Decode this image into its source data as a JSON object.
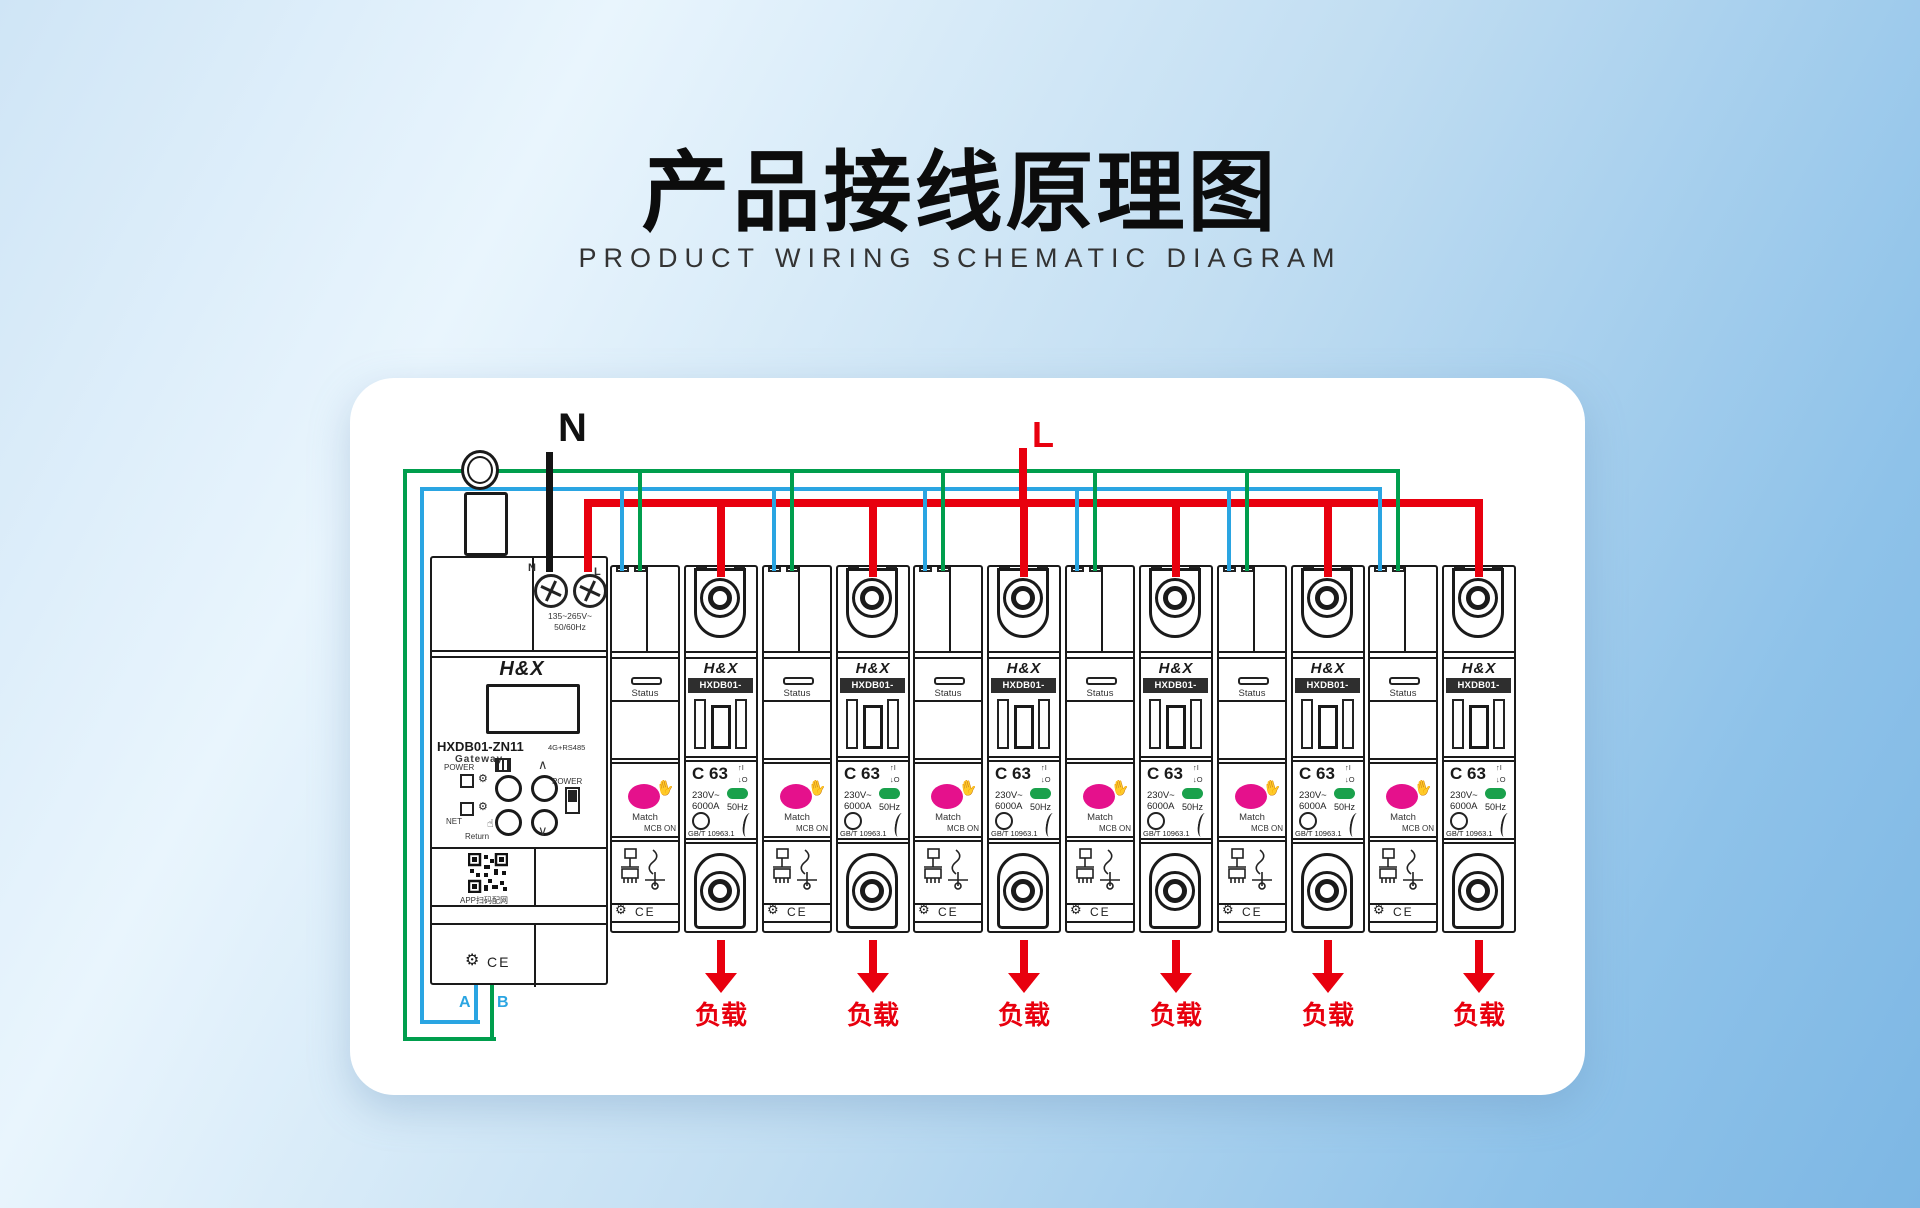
{
  "header": {
    "title": "产品接线原理图",
    "subtitle": "PRODUCT WIRING SCHEMATIC DIAGRAM"
  },
  "wiring": {
    "neutral_label": "N",
    "live_label": "L",
    "terminal_a_label": "A",
    "terminal_b_label": "B",
    "colors": {
      "live_red": "#e8000e",
      "neutral_black": "#141414",
      "rs485_a_blue": "#2aa5e2",
      "rs485_b_green": "#009e4d",
      "match_pink": "#e5118c",
      "freq_green": "#1aa14c",
      "load_red": "#e8000e"
    }
  },
  "gateway": {
    "brand": "H&X",
    "model": "HXDB01-ZN11",
    "type": "Gateway",
    "comm": "4G+RS485",
    "terminal_n": "N",
    "terminal_l": "L",
    "voltage_range": "135~265V~",
    "frequency": "50/60Hz",
    "power_led": "POWER",
    "net_led": "NET",
    "power_btn": "POWER",
    "return_btn": "Return",
    "up": "∧",
    "down": "∨",
    "qr_caption": "APP扫码配网",
    "cert": "CE"
  },
  "breaker": {
    "brand": "H&X",
    "model": "HXDB01-ZN11",
    "status": "Status",
    "match": "Match",
    "mcb_on": "MCB ON",
    "rating": "C 63",
    "voltage": "230V~",
    "breaking_capacity": "6000A",
    "frequency": "50Hz",
    "standard": "GB/T 10963.1",
    "on_marker": "I",
    "off_marker": "O",
    "cert": "CE",
    "count": 6
  },
  "loads": [
    "负载",
    "负载",
    "负载",
    "负载",
    "负载",
    "负载"
  ],
  "icons": {
    "gear": "⚙",
    "hand": "✋",
    "pointer": "☝",
    "arrow_up": "↑",
    "arrow_down": "↓"
  }
}
